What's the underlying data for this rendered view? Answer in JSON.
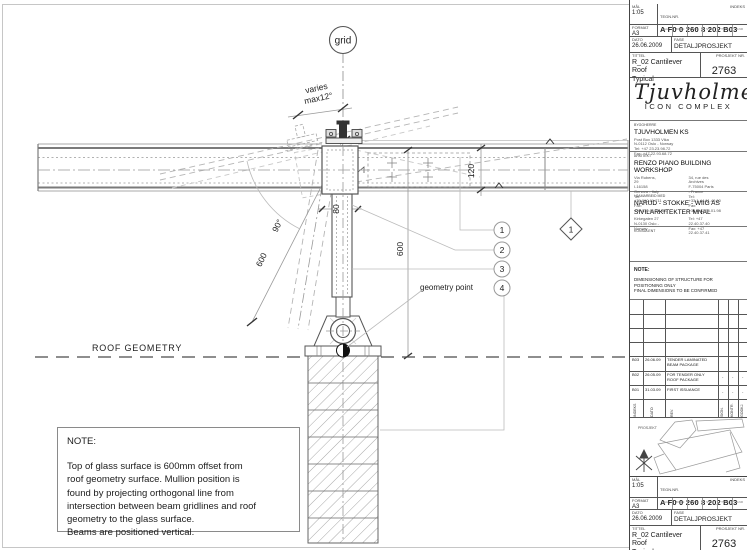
{
  "drawing": {
    "grid_bubble": "grid",
    "varies_line1": "varies",
    "varies_line2": "max12°",
    "dim_beam_depth": "120",
    "dim_mullion_width": "80",
    "dim_glass_offset": "600",
    "dim_offset_incline": "600",
    "angle_label": "90°",
    "geometry_point_label": "geometry point",
    "roof_geometry_label": "ROOF GEOMETRY",
    "callouts": [
      "1",
      "2",
      "3",
      "4"
    ],
    "grid_axis_marker": "1",
    "note_title": "NOTE:",
    "note_lines": [
      "Top of glass surface is 600mm offset from",
      "roof geometry surface. Mullion position is",
      "found by projecting orthogonal line from",
      "intersection between beam gridlines and roof",
      "geometry to the glass surface.",
      "Beams are positioned vertical."
    ]
  },
  "title_block": {
    "scale_label": "MÅL",
    "scale": "1:05",
    "drawing_no_label": "TEGN.NR.",
    "drawing_no": "A F0 0 260 8 202 B03",
    "index_label": "INDEKS",
    "format_label": "FORMAT",
    "format": "A3",
    "code_labels": [
      "FAG",
      "BYGN",
      "ETG",
      "SYST",
      "TYPE",
      "LNR"
    ],
    "date_label": "DATO",
    "date": "26.06.2009",
    "phase_label": "FASE",
    "phase": "DETALJPROSJEKT",
    "title_label": "TITTEL",
    "title_line1": "R_02 Cantilever Roof",
    "title_line2": "Typical",
    "project_no_label": "PROSJEKT NR.",
    "project_no": "2763",
    "logo_name": "Tjuvholmen",
    "logo_subtitle": "ICON COMPLEX",
    "client_label": "BYGGHERRE",
    "client_name": "TJUVHOLMEN KS",
    "client_lines": [
      "Post Box 1333 Vika",
      "N-0112 Oslo - Norway",
      "Tel: +47 23.23.98.72",
      "Fax: +47 22.93.68.72"
    ],
    "architect_label": "ARKITEKT",
    "architect_name": "RENZO PIANO BUILDING WORKSHOP",
    "architect_col1": [
      "Via Rubens, 29",
      "I-16158 Genova - Italy",
      "Tel: +39.010.61.711",
      "Fax: +39.010.61.71.350"
    ],
    "architect_col2": [
      "34, rue des Archives",
      "F-75004 Paris - France",
      "Tel: +33.1.44.61.49.00",
      "Fax: +33.1.42.78.01.98"
    ],
    "collab_label": "I SAMARBEID MED",
    "collab_name": "NARUD - STOKKE - WIIG AS",
    "collab_name2": "SIVILARKITEKTER MNAL",
    "collab_col1": [
      "Kirkegaten 27",
      "N-0130 Oslo - Norway"
    ],
    "collab_col2": [
      "Tel: +47 22.40.37.40",
      "Fax: +47 22.40.37.41"
    ],
    "consultant_label": "KONSULENT",
    "tb_note_title": "NOTE:",
    "tb_note_lines": [
      "DIMENSIONING OF STRUCTURE FOR",
      "POSITIONING ONLY",
      "FINAL DIMENSIONS TO BE CONFIRMED"
    ],
    "watermark": "FOR TENDER ONLY",
    "rev_headers": [
      "INDEKS",
      "DATO",
      "REV.",
      "SIGN.",
      "KONTR.",
      "GODKJ."
    ],
    "revisions": [
      {
        "idx": "B03",
        "date": "26.06.09",
        "desc": "TENDER LAMINATED BEAM PACKAGE",
        "sign": "",
        "kontr": "",
        "godkj": ""
      },
      {
        "idx": "B02",
        "date": "26.05.09",
        "desc": "FOR TENDER ONLY ROOF PACKAGE",
        "sign": "-",
        "kontr": "-",
        "godkj": "-"
      },
      {
        "idx": "B01",
        "date": "31.03.09",
        "desc": "FIRST ISSUANCE",
        "sign": "-",
        "kontr": "-",
        "godkj": "-"
      }
    ],
    "map_label": "PROSJEKT"
  }
}
